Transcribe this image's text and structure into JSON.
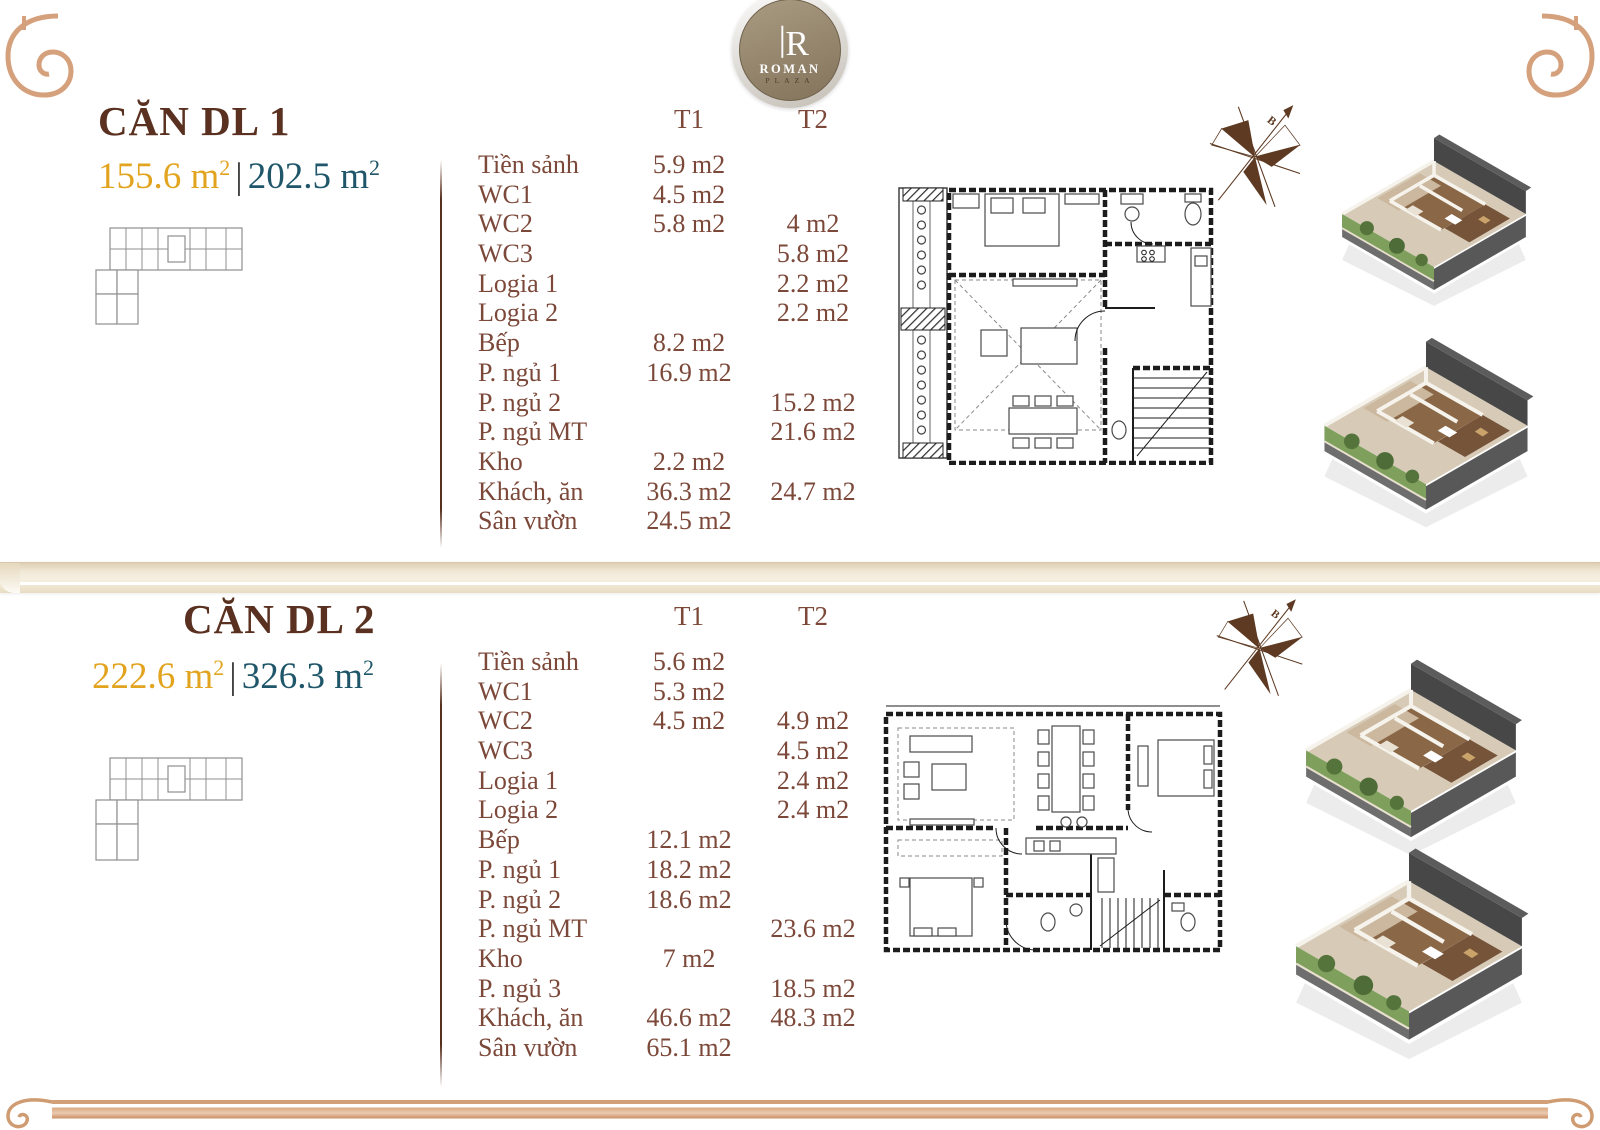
{
  "brand": {
    "monogram": "R",
    "name": "ROMAN",
    "sub": "PLAZA"
  },
  "colors": {
    "title_brown": "#5a3120",
    "table_brown": "#7b4839",
    "area_gold": "#e2a41f",
    "area_teal": "#1f5669",
    "ornament_copper": "#d5a07c",
    "ledge_beige": "#ede4cf",
    "unit1_highlight": "#e9b4a8",
    "unit2_highlight": "#ecc46f",
    "compass_brown": "#5e3a22"
  },
  "icons": {
    "compass": "compass-rose-icon (B = north arrow)",
    "volute": "classical-scroll-ornament",
    "logo": "roman-plaza-medallion"
  },
  "sections": [
    {
      "title": "CĂN DL 1",
      "area_primary": "155.6 m",
      "area_primary_sup": "2",
      "area_separator": "|",
      "area_secondary": "202.5 m",
      "area_secondary_sup": "2",
      "compass_label": "B",
      "table": {
        "col_t1": "T1",
        "col_t2": "T2",
        "rows": [
          {
            "label": "Tiền sảnh",
            "t1": "5.9 m2",
            "t2": ""
          },
          {
            "label": "WC1",
            "t1": "4.5 m2",
            "t2": ""
          },
          {
            "label": "WC2",
            "t1": "5.8 m2",
            "t2": "4 m2"
          },
          {
            "label": "WC3",
            "t1": "",
            "t2": "5.8 m2"
          },
          {
            "label": "Logia 1",
            "t1": "",
            "t2": "2.2 m2"
          },
          {
            "label": "Logia 2",
            "t1": "",
            "t2": "2.2 m2"
          },
          {
            "label": "Bếp",
            "t1": "8.2 m2",
            "t2": ""
          },
          {
            "label": "P. ngủ 1",
            "t1": "16.9 m2",
            "t2": ""
          },
          {
            "label": "P. ngủ 2",
            "t1": "",
            "t2": "15.2 m2"
          },
          {
            "label": "P. ngủ MT",
            "t1": "",
            "t2": "21.6 m2"
          },
          {
            "label": "Kho",
            "t1": "2.2 m2",
            "t2": ""
          },
          {
            "label": "Khách, ăn",
            "t1": "36.3 m2",
            "t2": "24.7 m2"
          },
          {
            "label": "Sân vườn",
            "t1": "24.5 m2",
            "t2": ""
          }
        ]
      }
    },
    {
      "title": "CĂN DL 2",
      "area_primary": "222.6 m",
      "area_primary_sup": "2",
      "area_separator": "|",
      "area_secondary": "326.3 m",
      "area_secondary_sup": "2",
      "compass_label": "B",
      "table": {
        "col_t1": "T1",
        "col_t2": "T2",
        "rows": [
          {
            "label": "Tiền sảnh",
            "t1": "5.6 m2",
            "t2": ""
          },
          {
            "label": "WC1",
            "t1": "5.3 m2",
            "t2": ""
          },
          {
            "label": "WC2",
            "t1": "4.5 m2",
            "t2": "4.9 m2"
          },
          {
            "label": "WC3",
            "t1": "",
            "t2": "4.5 m2"
          },
          {
            "label": "Logia 1",
            "t1": "",
            "t2": "2.4 m2"
          },
          {
            "label": "Logia 2",
            "t1": "",
            "t2": "2.4 m2"
          },
          {
            "label": "Bếp",
            "t1": "12.1 m2",
            "t2": ""
          },
          {
            "label": "P. ngủ 1",
            "t1": "18.2 m2",
            "t2": ""
          },
          {
            "label": "P. ngủ 2",
            "t1": "18.6 m2",
            "t2": ""
          },
          {
            "label": "P. ngủ MT",
            "t1": "",
            "t2": "23.6 m2"
          },
          {
            "label": "Kho",
            "t1": "7 m2",
            "t2": ""
          },
          {
            "label": "P. ngủ 3",
            "t1": "",
            "t2": "18.5 m2"
          },
          {
            "label": "Khách, ăn",
            "t1": "46.6 m2",
            "t2": "48.3 m2"
          },
          {
            "label": "Sân vườn",
            "t1": "65.1 m2",
            "t2": ""
          }
        ]
      }
    }
  ]
}
